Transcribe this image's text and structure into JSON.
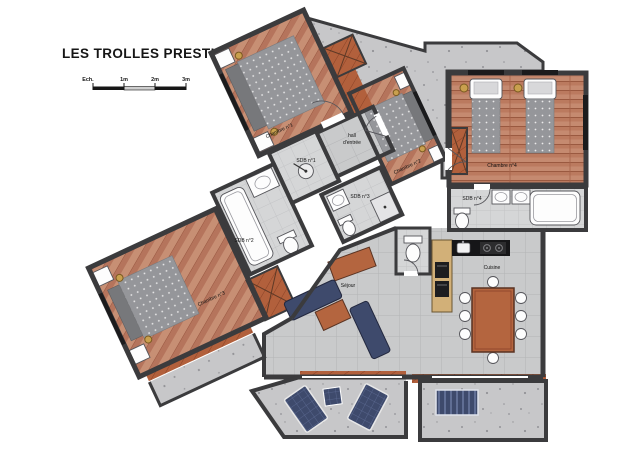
{
  "title": "LES TROLLES PRESTIGE N°2",
  "scale_bar": {
    "label": "Ech.",
    "ticks": [
      "1m",
      "2m",
      "3m"
    ]
  },
  "rooms": {
    "chambre1": "Chambre n°1",
    "chambre2": "Chambre n°2",
    "chambre3": "Chambre n°3",
    "chambre4": "Chambre n°4",
    "sdb1": "SDB n°1",
    "sdb2": "SDB n°2",
    "sdb3": "SDB n°3",
    "sdb4": "SDB n°4",
    "hall": {
      "line1": "hall",
      "line2": "d'entrée"
    },
    "sejour": "Séjour",
    "cuisine": "Cuisine"
  },
  "colors": {
    "wood_floor": "#c78f74",
    "wood_dark": "#b2603c",
    "tile_gray": "#c9cacb",
    "wall": "#3b3b3d",
    "terrace": "#c7c7c9",
    "sofa_navy": "#3e4a6c",
    "lamp_gold": "#c9a04e",
    "counter_black": "#161618",
    "cabinet_tan": "#d2b078"
  }
}
